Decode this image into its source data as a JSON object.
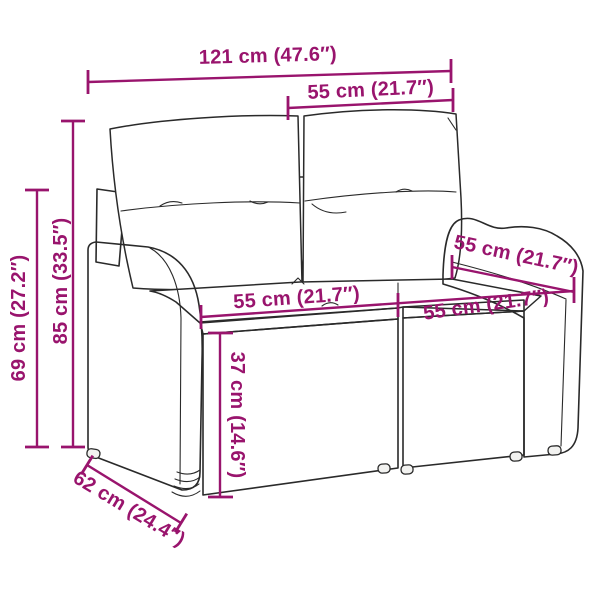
{
  "diagram": {
    "kind": "product-dimension-diagram",
    "subject": "poly rattan garden bench with cushions"
  },
  "colors": {
    "accent": "#99146d",
    "ink": "#2a2a2a",
    "background": "#ffffff"
  },
  "dimensions": {
    "total_width": "121 cm (47.6″)",
    "backrest_cushion_width": "55 cm (21.7″)",
    "overall_height": "85 cm (33.5″)",
    "armrest_height": "69 cm (27.2″)",
    "seat_width_left": "55 cm (21.7″)",
    "seat_width_right": "55 cm (21.7″)",
    "seat_depth": "55 cm (21.7″)",
    "seat_height": "37 cm (14.6″)",
    "overall_depth": "62 cm (24.4″)"
  }
}
